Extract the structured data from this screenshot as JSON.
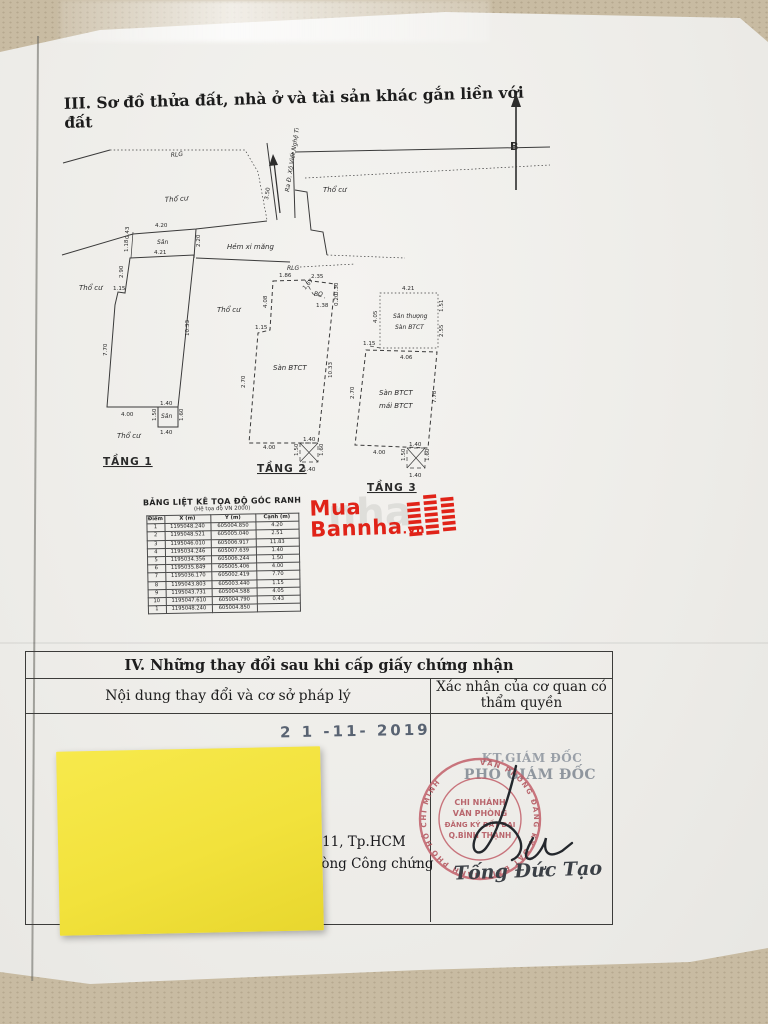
{
  "page": {
    "section3_title": "III. Sơ đồ thửa đất, nhà ở và tài sản khác gắn liền với đất",
    "north_label": "B"
  },
  "plan": {
    "labels": {
      "rlg": "RLG",
      "tho_cu": "Thổ cư",
      "street": "Ra Đ. Xô Viết Nghệ Tĩnh",
      "hem": "Hẻm xi măng",
      "san": "Sân",
      "bo": "BO",
      "san_btct": "Sàn BTCT",
      "san_thuong": "Sân thượng",
      "mai_btct": "mái BTCT",
      "floor1": "TẦNG 1",
      "floor2": "TẦNG 2",
      "floor3": "TẦNG 3"
    },
    "dims": {
      "d420": "4.20",
      "d043": "0.43",
      "d118": "1.18",
      "d421": "4.21",
      "d220": "2.20",
      "d290": "2.90",
      "d115": "1.15",
      "d350": "3.50",
      "d770": "7.70",
      "d1033": "10.33",
      "d400": "4.00",
      "d140": "1.40",
      "d150": "1.50",
      "d160": "1.60",
      "d186": "1.86",
      "d235": "2.35",
      "d167": "1.67",
      "d138": "1.38",
      "d030": "0.30",
      "d020": "0.20",
      "d408": "4.08",
      "d270": "2.70",
      "d151": "1.51",
      "d255": "2.55",
      "d405": "4.05",
      "d406": "4.06",
      "d778": "7.78"
    }
  },
  "coord_table": {
    "title": "BẢNG LIỆT KÊ TỌA ĐỘ GÓC RANH",
    "subtitle": "(Hệ tọa độ VN 2000)",
    "headers": [
      "Điểm",
      "X (m)",
      "Y (m)",
      "Cạnh (m)"
    ],
    "rows": [
      [
        "1",
        "1195048.240",
        "605004.850",
        "4.20"
      ],
      [
        "2",
        "1195048.521",
        "605005.040",
        "2.51"
      ],
      [
        "3",
        "1195046.010",
        "605006.917",
        "11.83"
      ],
      [
        "4",
        "1195034.246",
        "605007.639",
        "1.40"
      ],
      [
        "5",
        "1195034.356",
        "605006.244",
        "1.50"
      ],
      [
        "6",
        "1195035.849",
        "605005.406",
        "4.00"
      ],
      [
        "7",
        "1195036.170",
        "605002.419",
        "7.70"
      ],
      [
        "8",
        "1195043.803",
        "605003.440",
        "1.15"
      ],
      [
        "9",
        "1195043.731",
        "605004.588",
        "4.05"
      ],
      [
        "10",
        "1195047.610",
        "605004.790",
        "0.43"
      ],
      [
        "1",
        "1195048.240",
        "605004.850",
        ""
      ]
    ]
  },
  "logo": {
    "line1": "Mua",
    "line2": "Bannha",
    "suffix": ".vn",
    "watermark": "nha"
  },
  "section4": {
    "title": "IV. Những thay đổi sau khi cấp giấy chứng nhận",
    "col_left": "Nội dung thay đổi và cơ sở pháp lý",
    "col_right": "Xác nhận của cơ quan có thẩm quyền",
    "date_stamp": "2 1 -11- 2019",
    "left_line1": "ận 11, Tp.HCM",
    "left_line2": "phòng Công chứng",
    "kt_line1": "KT.GIÁM ĐỐC",
    "kt_line2": "PHÓ GIÁM ĐỐC",
    "stamp": {
      "line1": "CHI NHÁNH",
      "line2": "VĂN PHÒNG",
      "line3": "ĐĂNG KÝ ĐẤT ĐAI",
      "line4": "Q.BÌNH THẠNH",
      "ring": "VĂN PHÒNG ĐĂNG KÝ ĐẤT ĐAI THÀNH PHỐ HỒ CHÍ MINH"
    },
    "signer_name": "Tống Đức Tạo"
  }
}
